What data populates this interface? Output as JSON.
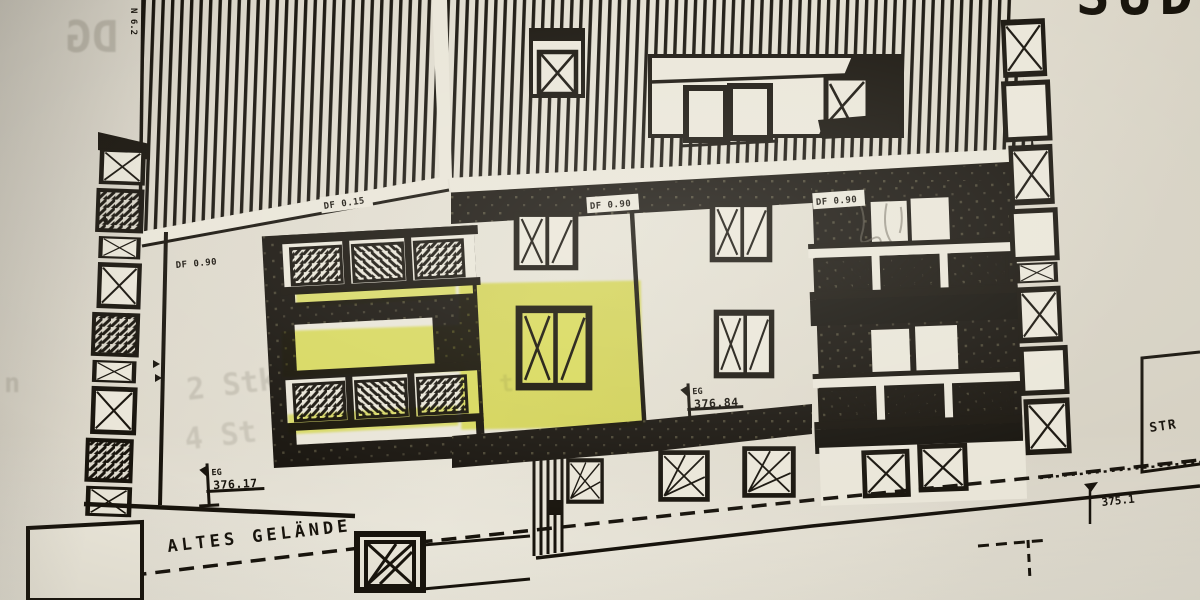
{
  "photo": {
    "partial_title": "SÜD"
  },
  "ghost_text": {
    "dg": "DG",
    "left1": "2 Stk",
    "left2": "4 St",
    "mid": "trennw",
    "edge": "n"
  },
  "annotations": {
    "altes_gelaende": "ALTES GELÄNDE",
    "street_partial": "STR",
    "roof_label": "N 6.2",
    "df_chip_left": "DF 0.90",
    "df_chip_left_roof": "DF 0.15",
    "df_chip_mid": "DF 0.90",
    "df_chip_right": "DF 0.90",
    "eg_left": {
      "line1": "EG",
      "line2": "376.17"
    },
    "eg_mid": {
      "line1": "EG",
      "line2": "376.84"
    },
    "spot_elevation": "375.1"
  },
  "colors": {
    "paper": "#e0dbce",
    "ink": "#17130c",
    "highlight": "#e9ef57"
  }
}
